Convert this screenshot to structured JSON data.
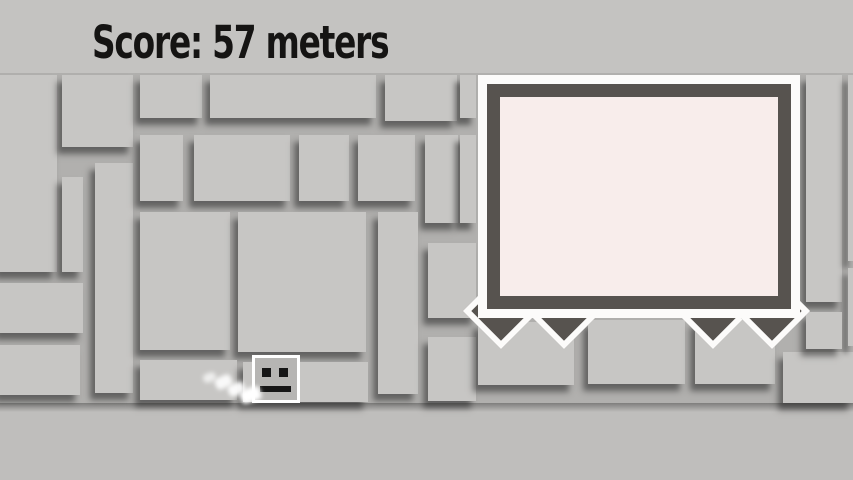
{
  "hud": {
    "score_text": "Score: 57 meters"
  },
  "scene": {
    "wall_blocks": [
      [
        0,
        75,
        57,
        197
      ],
      [
        62,
        75,
        71,
        72
      ],
      [
        62,
        177,
        21,
        95
      ],
      [
        95,
        163,
        38,
        230
      ],
      [
        0,
        283,
        83,
        50
      ],
      [
        0,
        345,
        80,
        50
      ],
      [
        140,
        75,
        62,
        43
      ],
      [
        210,
        75,
        166,
        43
      ],
      [
        385,
        75,
        72,
        46
      ],
      [
        460,
        75,
        16,
        43
      ],
      [
        140,
        135,
        43,
        66
      ],
      [
        194,
        135,
        96,
        66
      ],
      [
        299,
        135,
        50,
        66
      ],
      [
        358,
        135,
        57,
        66
      ],
      [
        425,
        135,
        33,
        88
      ],
      [
        460,
        135,
        16,
        88
      ],
      [
        140,
        212,
        90,
        138
      ],
      [
        238,
        212,
        128,
        140
      ],
      [
        378,
        212,
        40,
        182
      ],
      [
        428,
        243,
        48,
        75
      ],
      [
        428,
        337,
        48,
        64
      ],
      [
        140,
        360,
        97,
        40
      ],
      [
        243,
        362,
        125,
        40
      ],
      [
        478,
        322,
        96,
        63
      ],
      [
        588,
        320,
        97,
        64
      ],
      [
        695,
        320,
        80,
        64
      ],
      [
        783,
        352,
        70,
        51
      ],
      [
        806,
        75,
        36,
        227
      ],
      [
        848,
        75,
        5,
        186
      ],
      [
        848,
        268,
        5,
        78
      ],
      [
        806,
        312,
        36,
        37
      ]
    ],
    "spikes": [
      {
        "cx": 501,
        "cy": 311
      },
      {
        "cx": 564,
        "cy": 311
      },
      {
        "cx": 713,
        "cy": 311
      },
      {
        "cx": 772,
        "cy": 311
      }
    ],
    "dust_particles": [
      {
        "x": 203,
        "y": 373,
        "w": 13,
        "h": 9,
        "opacity": 0.7,
        "rot": -20
      },
      {
        "x": 215,
        "y": 376,
        "w": 17,
        "h": 12,
        "opacity": 0.9,
        "rot": -25
      },
      {
        "x": 228,
        "y": 383,
        "w": 17,
        "h": 12,
        "opacity": 0.95,
        "rot": -25
      },
      {
        "x": 240,
        "y": 388,
        "w": 21,
        "h": 14,
        "opacity": 1,
        "rot": -20
      }
    ],
    "player": {
      "x": 252,
      "y": 355,
      "w": 48,
      "h": 48
    }
  },
  "colors": {
    "header": "#c4c3c1",
    "wall_gap": "#b1b0ae",
    "block": "#c7c6c4",
    "floor": "#bfbebc",
    "panel_white": "#fcfbfa",
    "panel_dark": "#57534f",
    "panel_screen": "#f8edeb",
    "spike": "#57534f",
    "player_fill": "#b6b5b3",
    "player_face": "#161616",
    "score_text": "#151413"
  }
}
